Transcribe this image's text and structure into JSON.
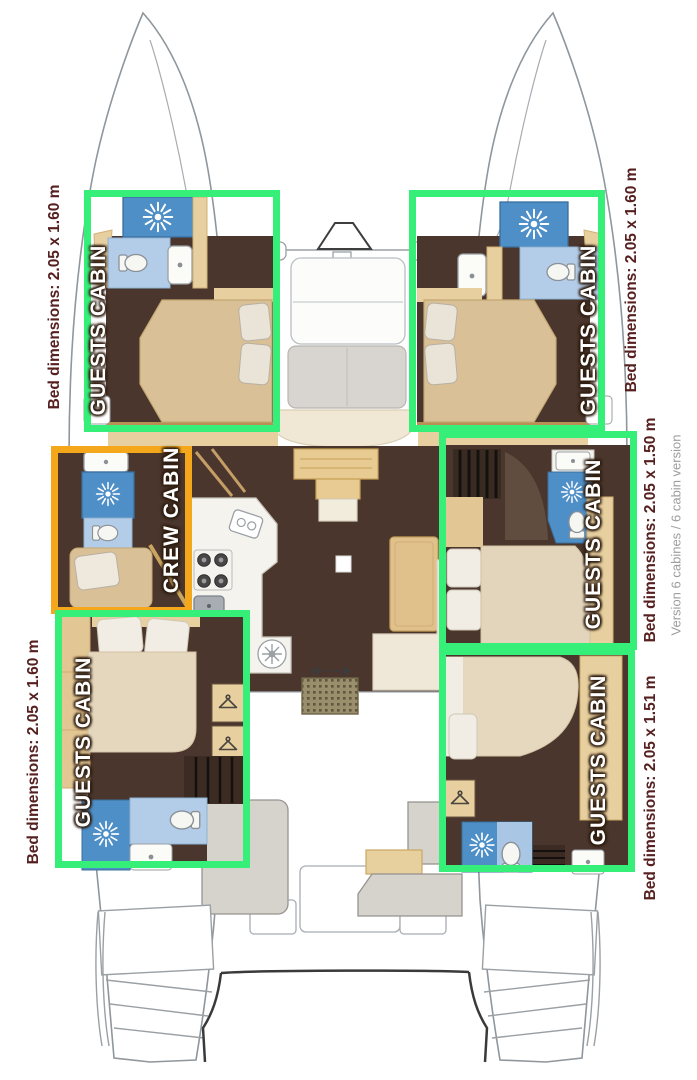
{
  "colors": {
    "guest_highlight": "#35ef78",
    "crew_highlight": "#f4a71b",
    "dimension_text": "#572020",
    "version_text": "#9d9d9d",
    "label_text": "#ffffff",
    "bathroom_blue": "#4e8fc7",
    "bathroom_light_blue": "#a9c7e4",
    "floor_brown": "#4a362c",
    "wood_tan": "#e7cf9f"
  },
  "cabins": [
    {
      "id": "guest-fore-port",
      "type": "guest",
      "label": "GUESTS CABIN",
      "bed_dimensions": "Bed dimensions: 2.05 x 1.60 m"
    },
    {
      "id": "guest-fore-starboard",
      "type": "guest",
      "label": "GUESTS CABIN",
      "bed_dimensions": "Bed dimensions: 2.05 x 1.60 m"
    },
    {
      "id": "guest-mid-starboard",
      "type": "guest",
      "label": "GUESTS CABIN",
      "bed_dimensions": "Bed dimensions: 2.05 x 1.50 m"
    },
    {
      "id": "guest-aft-starboard",
      "type": "guest",
      "label": "GUESTS CABIN",
      "bed_dimensions": "Bed dimensions: 2.05 x 1.51 m"
    },
    {
      "id": "guest-aft-port",
      "type": "guest",
      "label": "GUESTS CABIN",
      "bed_dimensions": "Bed dimensions: 2.05 x 1.60 m"
    },
    {
      "id": "crew-mid-port",
      "type": "crew",
      "label": "CREW CABIN",
      "bed_dimensions": ""
    }
  ],
  "version_note": "Version 6 cabines / 6 cabin version"
}
